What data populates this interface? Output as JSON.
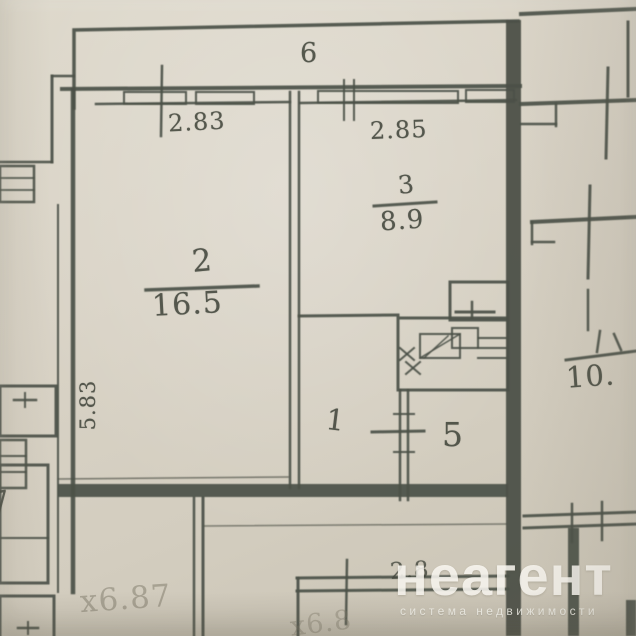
{
  "plan": {
    "balcony_label": "6",
    "rooms": {
      "room2": {
        "number": "2",
        "area": "16.5"
      },
      "room3": {
        "number": "3",
        "area": "8.9"
      },
      "room1": {
        "number": "1"
      },
      "room5": {
        "number": "5"
      },
      "neighbor_right_area_partial": "10.",
      "neighbor_left_partial": "7"
    },
    "dimensions": {
      "width_room2": "2.83",
      "width_room3": "2.85",
      "height_room2": "5.83",
      "bottom_width": "2.8",
      "pencil_note_left": "х6.87",
      "pencil_note_bottom": "х6.8"
    }
  },
  "watermark": {
    "logo": "неагент",
    "tagline": "система недвижимости"
  },
  "colors": {
    "paper": "#d8d2c6",
    "ink": "#4a4e43",
    "pencil": "#8a8578",
    "watermark_text": "#f6f3ec"
  }
}
